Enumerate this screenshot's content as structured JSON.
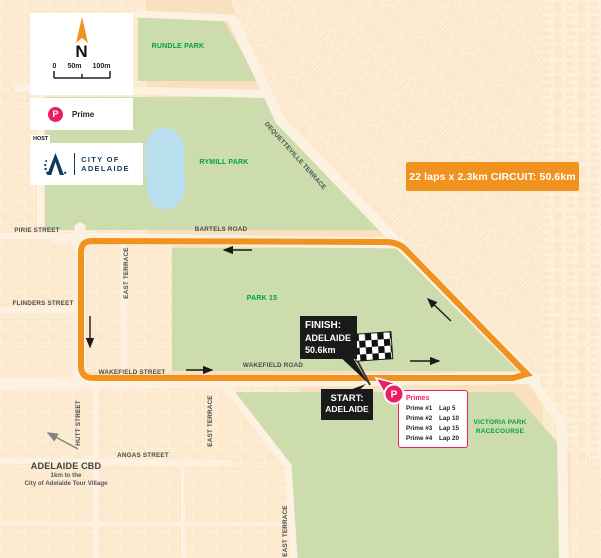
{
  "legend": {
    "north": "N",
    "scale": {
      "zero": "0",
      "fifty": "50m",
      "hundred": "100m"
    },
    "prime_symbol": "P",
    "prime_label": "Prime",
    "host_label": "HOST",
    "logo_line1": "CITY OF",
    "logo_line2": "ADELAIDE"
  },
  "banner": {
    "text": "22 laps x 2.3km CIRCUIT: 50.6km"
  },
  "parks": {
    "rundle": "RUNDLE PARK",
    "rymill": "RYMILL PARK",
    "park15": "PARK 15",
    "victoria_line1": "VICTORIA PARK",
    "victoria_line2": "RACECOURSE"
  },
  "streets": {
    "bartels": "BARTELS ROAD",
    "dequetteville": "DEQUETTEVILLE TERRACE",
    "pirie": "PIRIE STREET",
    "flinders": "FLINDERS STREET",
    "east_terrace": "EAST TERRACE",
    "wakefield_street": "WAKEFIELD STREET",
    "wakefield_road": "WAKEFIELD ROAD",
    "hutt": "HUTT STREET",
    "angas": "ANGAS STREET"
  },
  "markers": {
    "finish_line1": "FINISH:",
    "finish_line2": "ADELAIDE",
    "finish_line3": "50.6km",
    "start_line1": "START:",
    "start_line2": "ADELAIDE",
    "prime_pin": "P"
  },
  "primes": {
    "title": "Primes",
    "rows": [
      {
        "name": "Prime #1",
        "lap": "Lap 5"
      },
      {
        "name": "Prime #2",
        "lap": "Lap 10"
      },
      {
        "name": "Prime #3",
        "lap": "Lap 15"
      },
      {
        "name": "Prime #4",
        "lap": "Lap 20"
      }
    ]
  },
  "cbd": {
    "title": "ADELAIDE CBD",
    "line1": "1km to the",
    "line2": "City of Adelaide Tour Village"
  },
  "colors": {
    "route_orange": "#F1921E",
    "park_green": "#CCDCAD",
    "label_green": "#00A14B",
    "prime_pink": "#EC1E63",
    "logo_navy": "#12395F",
    "map_peach": "#F9E0BE",
    "street_gray": "#4B4B4D",
    "lake_blue": "#B9DFEE"
  }
}
